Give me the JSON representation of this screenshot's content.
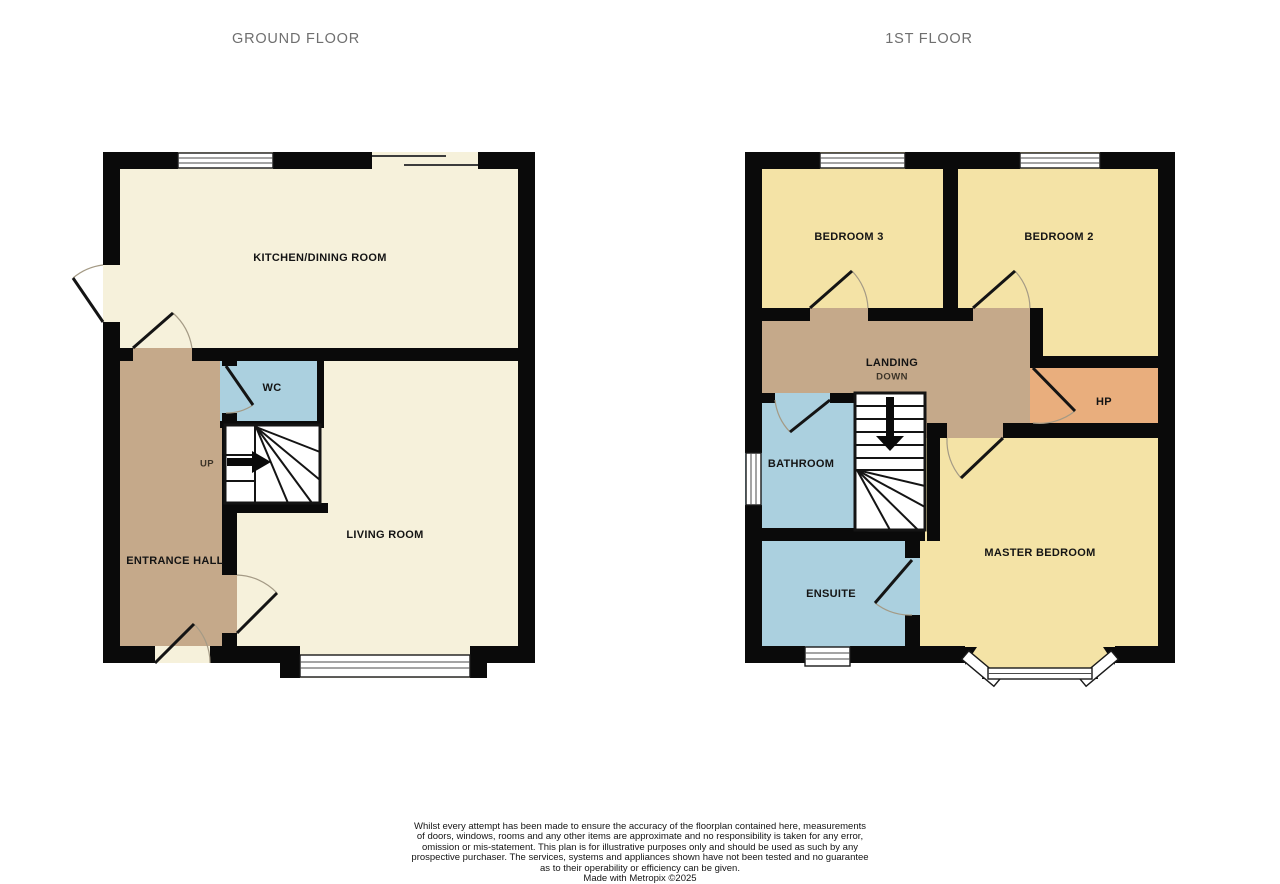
{
  "titles": {
    "ground": "GROUND FLOOR",
    "first": "1ST FLOOR"
  },
  "ground_floor": {
    "kitchen": "KITCHEN/DINING ROOM",
    "wc": "WC",
    "stairs_direction": "UP",
    "hall": "ENTRANCE HALL",
    "living": "LIVING ROOM"
  },
  "first_floor": {
    "bedroom3": "BEDROOM 3",
    "bedroom2": "BEDROOM 2",
    "landing": "LANDING",
    "stairs_direction": "DOWN",
    "hp": "HP",
    "bathroom": "BATHROOM",
    "master": "MASTER BEDROOM",
    "ensuite": "ENSUITE"
  },
  "palette": {
    "wall": "#0a0a0a",
    "room_cream": "#f6f1db",
    "room_yellow": "#f4e3a6",
    "room_tan": "#c5a98a",
    "room_blue": "#abd0df",
    "room_orange": "#e9ae7d",
    "title_gray": "#6f6f6f"
  },
  "footer": {
    "lines": [
      "Whilst every attempt has been made to ensure the accuracy of the floorplan contained here, measurements",
      "of doors, windows, rooms and any other items are approximate and no responsibility is taken for any error,",
      "omission or mis-statement. This plan is for illustrative purposes only and should be used as such by any",
      "prospective purchaser. The services, systems and appliances shown have not been tested and no guarantee",
      "as to their operability or efficiency can be given.",
      "Made with Metropix ©2025"
    ]
  }
}
